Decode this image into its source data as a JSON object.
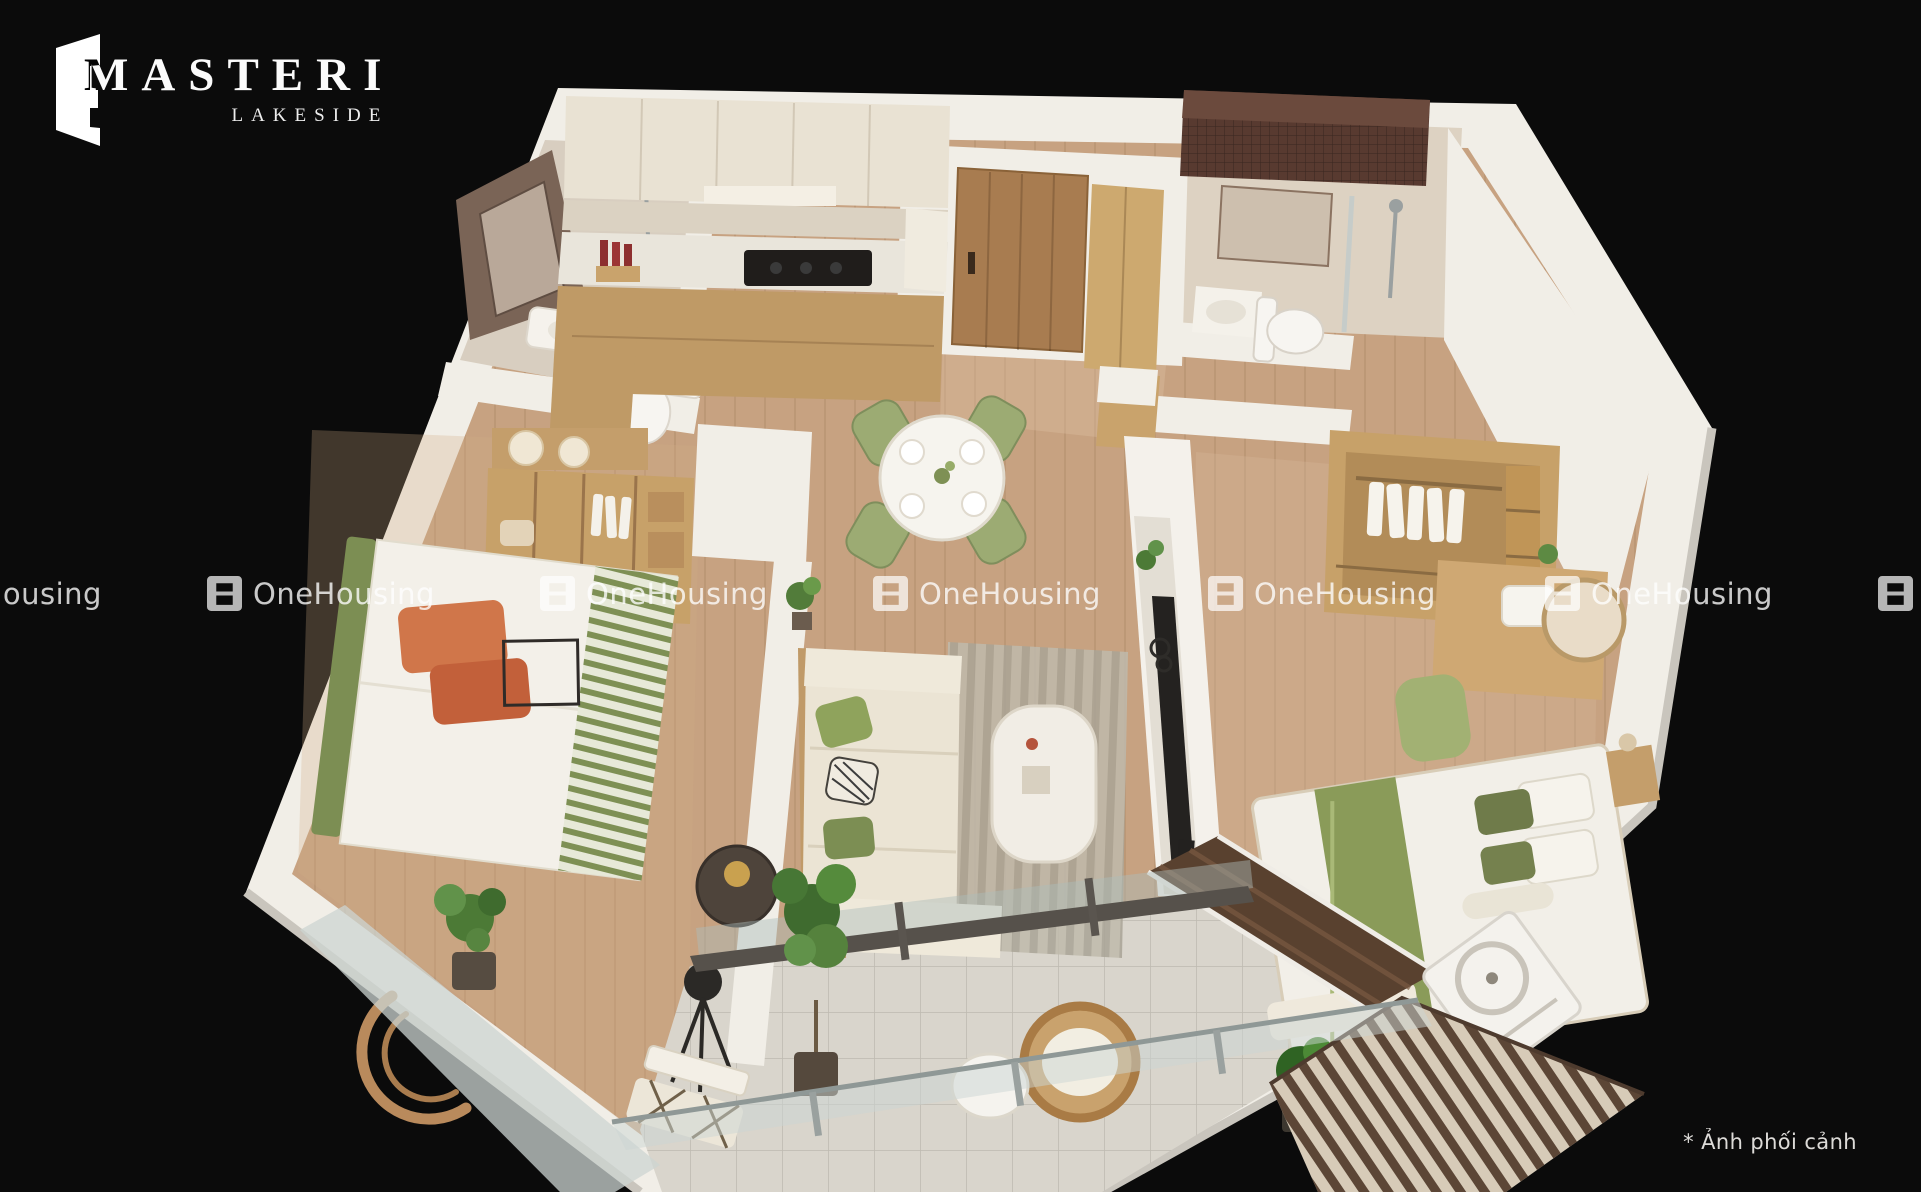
{
  "branding": {
    "title": "MASTERI",
    "subtitle": "LAKESIDE"
  },
  "watermark": {
    "label": "OneHousing",
    "icon": "onehousing-logo-icon",
    "row_top": 576,
    "positions_x": [
      -126,
      207,
      540,
      873,
      1208,
      1545,
      1878
    ]
  },
  "caption": "* Ảnh phối cảnh",
  "colors": {
    "background": "#0b0b0b",
    "wall_white": "#f1eee7",
    "wall_shade": "#c9c5bd",
    "wood_floor": "#c7a281",
    "bedroom_floor": "#d2ac84",
    "hall_floor": "#e2c8a8",
    "bath_tile": "#d8cec0",
    "balcony_tile": "#d9d5cc",
    "dark_mosaic": "#583a30",
    "window_glass": "#59412f",
    "cabinet_cream": "#e9e2d3",
    "counter_marble": "#e9e5db",
    "furniture_wood": "#c49e6b",
    "door_wood": "#a87c50",
    "accent_green": "#9cab73",
    "bedding_green": "#8a9b59",
    "accent_orange": "#d0764a",
    "sofa_cream": "#ebe4d4",
    "rug_gray": "#bfbaab",
    "cooktop_black": "#201d1b",
    "watermark_white": "#ffffff"
  }
}
